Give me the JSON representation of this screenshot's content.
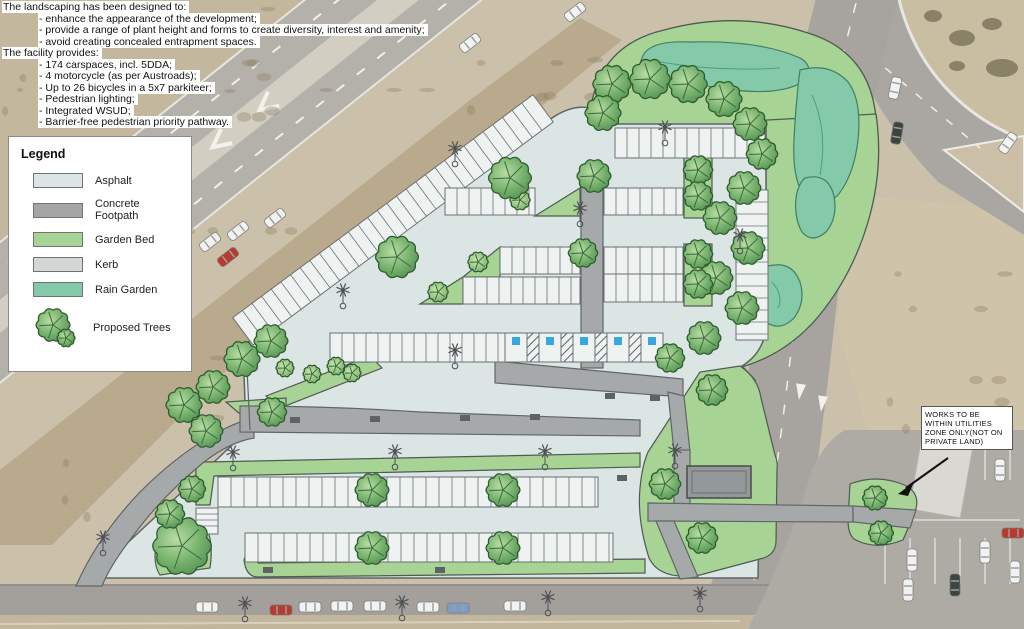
{
  "notes": {
    "lines": [
      {
        "text": "The landscaping has been designed to:",
        "indent": 0
      },
      {
        "text": "- enhance the appearance of the development;",
        "indent": 1
      },
      {
        "text": "- provide a range of plant height and forms to create diversity, interest and amenity;",
        "indent": 1
      },
      {
        "text": "- avoid creating concealed entrapment spaces.",
        "indent": 1
      },
      {
        "text": "The facility provides:",
        "indent": 0
      },
      {
        "text": "- 174 carspaces, incl. 5DDA;",
        "indent": 1
      },
      {
        "text": "- 4 motorcycle (as per Austroads);",
        "indent": 1
      },
      {
        "text": "- Up to 26 bicycles in a 5x7 parkiteer;",
        "indent": 1
      },
      {
        "text": "- Pedestrian lighting;",
        "indent": 1
      },
      {
        "text": "- Integrated WSUD;",
        "indent": 1
      },
      {
        "text": "- Barrier-free pedestrian priority pathway.",
        "indent": 1
      }
    ]
  },
  "legend": {
    "title": "Legend",
    "items": [
      {
        "label": "Asphalt",
        "type": "swatch",
        "color": "#dbe5e4"
      },
      {
        "label": "Concrete Footpath",
        "type": "swatch",
        "color": "#a3a5a7"
      },
      {
        "label": "Garden Bed",
        "type": "swatch",
        "color": "#a7d394"
      },
      {
        "label": "Kerb",
        "type": "swatch",
        "color": "#d4d6d5"
      },
      {
        "label": "Rain Garden",
        "type": "swatch",
        "color": "#84c9a8"
      },
      {
        "label": "Proposed Trees",
        "type": "tree"
      }
    ]
  },
  "annotation": {
    "lines": [
      "WORKS TO BE",
      "WITHIN UTILITIES",
      "ZONE ONLY(NOT ON",
      "PRIVATE LAND)"
    ]
  },
  "aerial": {
    "road_text": "KEEP"
  },
  "colors": {
    "asphalt": "#dbe5e4",
    "concrete": "#a6a9aa",
    "garden": "#a7d394",
    "kerb": "#d4d6d5",
    "rain": "#84c9a8",
    "bay_fill": "#eef3f2",
    "dda_blue": "#35a8dd",
    "outline": "#4e5a52"
  },
  "plan": {
    "trees": [
      [
        612,
        84,
        17
      ],
      [
        650,
        79,
        18
      ],
      [
        688,
        84,
        17
      ],
      [
        724,
        99,
        16
      ],
      [
        750,
        124,
        15
      ],
      [
        762,
        154,
        14
      ],
      [
        744,
        188,
        15
      ],
      [
        720,
        218,
        15
      ],
      [
        748,
        248,
        15
      ],
      [
        716,
        278,
        15
      ],
      [
        742,
        308,
        15
      ],
      [
        704,
        338,
        15
      ],
      [
        670,
        358,
        13
      ],
      [
        712,
        390,
        14
      ],
      [
        182,
        546,
        26
      ],
      [
        170,
        514,
        13
      ],
      [
        192,
        489,
        12
      ],
      [
        206,
        431,
        15
      ],
      [
        184,
        405,
        16
      ],
      [
        213,
        387,
        15
      ],
      [
        242,
        359,
        16
      ],
      [
        271,
        341,
        15
      ],
      [
        397,
        257,
        19
      ],
      [
        510,
        178,
        19
      ],
      [
        603,
        113,
        16
      ],
      [
        594,
        176,
        15
      ],
      [
        583,
        253,
        13
      ],
      [
        698,
        170,
        13
      ],
      [
        698,
        196,
        13
      ],
      [
        698,
        254,
        13
      ],
      [
        698,
        284,
        13
      ],
      [
        372,
        490,
        15
      ],
      [
        503,
        490,
        15
      ],
      [
        372,
        548,
        15
      ],
      [
        503,
        548,
        15
      ],
      [
        272,
        412,
        13
      ],
      [
        665,
        484,
        14
      ],
      [
        702,
        538,
        14
      ],
      [
        875,
        498,
        11
      ],
      [
        881,
        533,
        11
      ]
    ],
    "shrubs": [
      [
        285,
        368,
        8
      ],
      [
        312,
        374,
        8
      ],
      [
        336,
        366,
        8
      ],
      [
        352,
        373,
        8
      ],
      [
        438,
        292,
        9
      ],
      [
        478,
        262,
        9
      ],
      [
        520,
        200,
        9
      ]
    ],
    "poles": [
      [
        455,
        148
      ],
      [
        343,
        290
      ],
      [
        580,
        208
      ],
      [
        665,
        127
      ],
      [
        740,
        235
      ],
      [
        455,
        350
      ],
      [
        233,
        452
      ],
      [
        395,
        451
      ],
      [
        545,
        451
      ],
      [
        675,
        450
      ],
      [
        103,
        537
      ],
      [
        245,
        603
      ],
      [
        402,
        602
      ],
      [
        548,
        597
      ],
      [
        700,
        593
      ]
    ],
    "benches": [
      [
        295,
        420
      ],
      [
        375,
        419
      ],
      [
        465,
        418
      ],
      [
        535,
        417
      ],
      [
        268,
        570
      ],
      [
        440,
        570
      ],
      [
        622,
        478
      ],
      [
        610,
        396
      ],
      [
        655,
        398
      ]
    ],
    "rows": [
      {
        "x": 253,
        "y": 345,
        "w": 374,
        "h": 34,
        "rot": -36.6,
        "pitch": 12
      },
      {
        "x": 615,
        "y": 128,
        "w": 150,
        "h": 30,
        "pitch": 12
      },
      {
        "x": 445,
        "y": 188,
        "w": 90,
        "h": 27,
        "pitch": 12
      },
      {
        "x": 604,
        "y": 188,
        "w": 79,
        "h": 27,
        "pitch": 12
      },
      {
        "x": 500,
        "y": 247,
        "w": 80,
        "h": 27,
        "pitch": 12
      },
      {
        "x": 463,
        "y": 277,
        "w": 117,
        "h": 27,
        "pitch": 12
      },
      {
        "x": 604,
        "y": 247,
        "w": 79,
        "h": 27,
        "pitch": 12
      },
      {
        "x": 604,
        "y": 274,
        "w": 79,
        "h": 28,
        "pitch": 12
      },
      {
        "x": 736,
        "y": 190,
        "w": 32,
        "h": 150,
        "pitch": 12,
        "vertical": true
      },
      {
        "x": 330,
        "y": 333,
        "w": 175,
        "h": 29,
        "pitch": 12
      },
      {
        "x": 218,
        "y": 477,
        "w": 380,
        "h": 30,
        "pitch": 13
      },
      {
        "x": 245,
        "y": 533,
        "w": 368,
        "h": 29,
        "pitch": 13
      },
      {
        "x": 196,
        "y": 508,
        "w": 22,
        "h": 26,
        "pitch": 6,
        "vertical": true
      }
    ],
    "dda": {
      "x": 505,
      "y": 333,
      "h": 29,
      "bay": 22,
      "hatch": 12,
      "count": 5
    },
    "cars": [
      [
        207,
        607,
        0,
        "w"
      ],
      [
        281,
        610,
        0,
        "r"
      ],
      [
        310,
        607,
        0,
        "w"
      ],
      [
        342,
        606,
        0,
        "w"
      ],
      [
        375,
        606,
        0,
        "w"
      ],
      [
        428,
        607,
        0,
        "w"
      ],
      [
        458,
        608,
        0,
        "b"
      ],
      [
        515,
        606,
        0,
        "w"
      ],
      [
        210,
        242,
        -38,
        "w"
      ],
      [
        238,
        231,
        -38,
        "w"
      ],
      [
        275,
        218,
        -38,
        "w"
      ],
      [
        228,
        257,
        -38,
        "r"
      ],
      [
        90,
        330,
        -38,
        "w"
      ],
      [
        58,
        349,
        -38,
        "w"
      ],
      [
        575,
        12,
        -38,
        "w"
      ],
      [
        470,
        43,
        -38,
        "w"
      ],
      [
        895,
        88,
        -78,
        "w"
      ],
      [
        897,
        133,
        -80,
        "d"
      ],
      [
        1008,
        143,
        -55,
        "w"
      ],
      [
        912,
        560,
        90,
        "w"
      ],
      [
        908,
        590,
        90,
        "w"
      ],
      [
        985,
        552,
        90,
        "w"
      ],
      [
        1013,
        533,
        0,
        "r"
      ],
      [
        1015,
        572,
        90,
        "w"
      ],
      [
        955,
        585,
        90,
        "d"
      ],
      [
        1000,
        470,
        90,
        "w"
      ]
    ],
    "car_colors": {
      "w": "#f2f2f0",
      "r": "#b8392e",
      "b": "#7f9ec7",
      "d": "#3d4440"
    }
  }
}
